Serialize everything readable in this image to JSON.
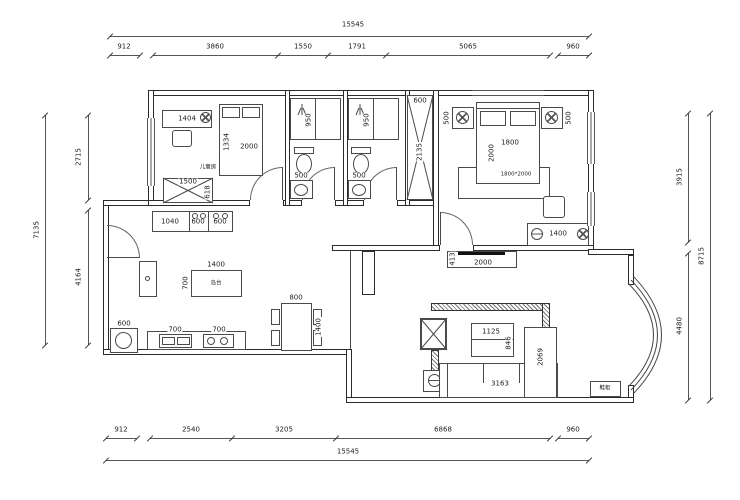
{
  "accent_color": "#2b2b2b",
  "dims": {
    "top": {
      "total": "15545",
      "s": [
        "912",
        "3860",
        "1550",
        "1791",
        "5065",
        "960"
      ]
    },
    "bottom": {
      "total": "15545",
      "s": [
        "912",
        "2540",
        "3205",
        "6868",
        "960"
      ]
    },
    "left": {
      "total": "7135",
      "s": [
        "2715",
        "4164"
      ]
    },
    "right": {
      "total": "8715",
      "s": [
        "3915",
        "4480"
      ]
    }
  },
  "kids_room": {
    "name": "儿童房",
    "desk": "1404",
    "bed_w": "1334",
    "bed_l": "2000",
    "ward_w": "1500",
    "ward_d": "618"
  },
  "bath_left": {
    "shower": "950",
    "vanity": "500"
  },
  "bath_right": {
    "shower": "950",
    "vanity": "500"
  },
  "hall_cabinet": {
    "w": "600",
    "h": "2135"
  },
  "master": {
    "ns_l": "500",
    "ns_r": "500",
    "bed_w": "1800",
    "bed_l": "2000",
    "rug": "1800*2000",
    "dresser": "1400"
  },
  "tv_wall": {
    "w": "2000",
    "d": "413"
  },
  "living": {
    "table_w": "1125",
    "table_d": "846",
    "sofa_w": "3163",
    "sofa_d": "2069",
    "shoe": "鞋柜"
  },
  "kitchen": {
    "c1": "1040",
    "c2": "600",
    "c3": "600",
    "isl_w": "1400",
    "isl_d": "700",
    "isl_name": "岛台",
    "washer": "600",
    "sink": "700",
    "cook": "700"
  },
  "dining": {
    "w": "800",
    "l": "1400"
  }
}
